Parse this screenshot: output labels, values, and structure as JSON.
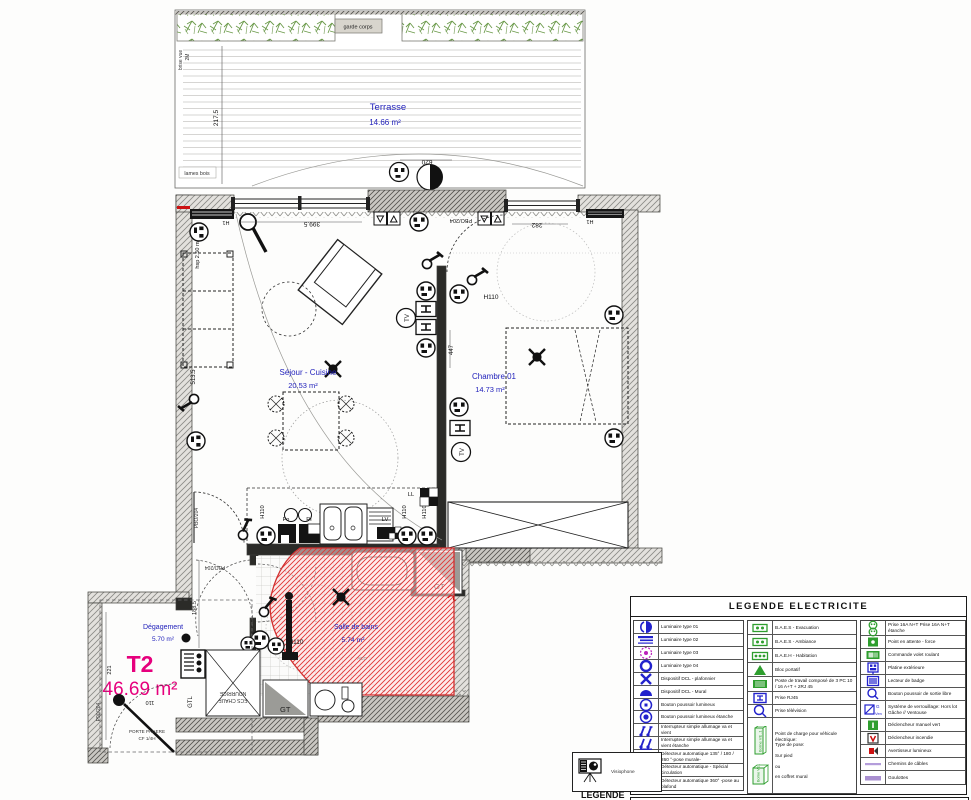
{
  "colors": {
    "room_label": "#2222bb",
    "unit_label": "#e6007d",
    "highlight_red": "#dd2222",
    "legend_blue": "#2222cc",
    "legend_green": "#2e9e2e",
    "legend_magenta": "#bb22bb",
    "legend_lavender": "#b49ddb",
    "plants_green": "#6b9a4a"
  },
  "plan": {
    "texts": {
      "terrasse": "Terrasse",
      "terrasse_area": "14.66 m²",
      "sejour": "Séjour - Cuisine",
      "sejour_area": "20.53 m²",
      "chambre": "Chambre 01",
      "chambre_area": "14.73 m²",
      "sdb": "Salle de bains",
      "sdb_area": "5.74 m²",
      "degagement": "Dégagement",
      "degagement_area": "5.70 m²",
      "unit": "T2",
      "unit_area": "46.69 m²",
      "garde_corps": "garde corps",
      "brise_vue": "brise vue",
      "deux_m": "2M",
      "lames_bois": "lames bois",
      "hsp": "hsp 2.50 m",
      "dim_217_5": "217.5",
      "dim_620": "620",
      "dim_399_5": "399.5",
      "dim_282": "282",
      "dim_447": "447",
      "dim_513_5": "513.5",
      "dim_188_5": "188.5",
      "dim_221": "221",
      "dim_110": "110",
      "h1": "H1",
      "h110": "H110",
      "h180": "H180",
      "pbo": "PBO/204",
      "p90": "P90/204",
      "ll": "LL",
      "lv": "LV",
      "fo": "Fo",
      "pi": "PI",
      "gt": "GT",
      "gtl": "GTL",
      "nourrice": "NOURRICE",
      "ecs": "ECS CHAUF",
      "porte1": "PORTE PALIERE",
      "porte2": "CF 1/4H",
      "tv": "TV",
      "acc": "ACC"
    }
  },
  "legend": {
    "title": "LEGENDE ELECTRICITE",
    "bottom_word": "LEGENDE",
    "visiophone": "Visiophone",
    "icon_texts": {
      "verrou_g": "G",
      "verrou_ven": "Ven",
      "borne": "Borne VE .1"
    },
    "columns": [
      [
        {
          "icon": "lum01",
          "label": "Luminaire type 01",
          "h": 13
        },
        {
          "icon": "lum02",
          "label": "Luminaire type 02",
          "h": 13
        },
        {
          "icon": "lum03",
          "label": "Luminaire type 03",
          "h": 13
        },
        {
          "icon": "lum04",
          "label": "Luminaire type 04",
          "h": 13
        },
        {
          "icon": "dclPlaf",
          "label": "Dispositif DCL - plafonnier",
          "h": 13
        },
        {
          "icon": "dclMural",
          "label": "Dispositif DCL - Mural",
          "h": 13
        },
        {
          "icon": "bpLum",
          "label": "Bouton poussoir lumineux",
          "h": 12
        },
        {
          "icon": "bpLumEt",
          "label": "Bouton poussoir lumineux étanche",
          "h": 13
        },
        {
          "icon": "intSimple",
          "label": "Interrupteur simple allumage va et vient",
          "h": 13
        },
        {
          "icon": "intSimpleEt",
          "label": "Interrupteur simple allumage va et vient étanche",
          "h": 13
        },
        {
          "icon": "det135",
          "label": "Détecteur automatique 135° / 180 / 260 °-pose murale-",
          "h": 14
        },
        {
          "icon": "detSpec",
          "label": "Détecteur automatique - Spécial circulation",
          "h": 13
        },
        {
          "icon": "det360",
          "label": "Détecteur automatique 360° -pose au plafond",
          "h": 13
        }
      ],
      [
        {
          "icon": "baes",
          "label": "B.A.E.S - Evacuation",
          "h": 14
        },
        {
          "icon": "baes",
          "label": "B.A.E.S - Ambiance",
          "h": 14
        },
        {
          "icon": "baeh",
          "label": "B.A.E.H - Habitation",
          "h": 14
        },
        {
          "icon": "bloc",
          "label": "Bloc portatif",
          "h": 14
        },
        {
          "icon": "poste",
          "label": "Poste de travail composé de 3 PC 10 / 16 A+T + 2RJ 45",
          "h": 15
        },
        {
          "icon": "rj45",
          "label": "Prise RJ45",
          "h": 13
        },
        {
          "icon": "tv",
          "label": "Prise télévision",
          "h": 13
        },
        {
          "icon": "borne",
          "label": "",
          "h": 75,
          "lines": [
            "Point de charge pour véhicule",
            "électrique:",
            "Type de pose:",
            "",
            "Sur pied",
            "",
            "ou",
            "",
            "en coffret mural"
          ]
        }
      ],
      [
        {
          "icon": "prise16",
          "label": "Prise 16A N+T Prise 16A N+T étanche",
          "h": 15
        },
        {
          "icon": "pointAttente",
          "label": "Point en attente - force",
          "h": 13
        },
        {
          "icon": "cmdVolet",
          "label": "Commande volet roulant",
          "h": 13
        },
        {
          "icon": "platine",
          "label": "Platine extérieure",
          "h": 13
        },
        {
          "icon": "badge",
          "label": "Lecteur de badge",
          "h": 13
        },
        {
          "icon": "bpSortie",
          "label": "Bouton poussoir de sortie libre",
          "h": 13
        },
        {
          "icon": "verrou",
          "label": "Système de verrouillage: Hors lot Gâche // Ventouse",
          "h": 18
        },
        {
          "icon": "declVert",
          "label": "Déclencheur manuel vert",
          "h": 13
        },
        {
          "icon": "declInc",
          "label": "Déclencheur incendie",
          "h": 13
        },
        {
          "icon": "avert",
          "label": "Avertisseur lumineux",
          "h": 13
        },
        {
          "icon": "chemins",
          "label": "Chemins de câbles",
          "h": 13
        },
        {
          "icon": "goulottes",
          "label": "Goulottes",
          "h": 13
        }
      ]
    ]
  }
}
